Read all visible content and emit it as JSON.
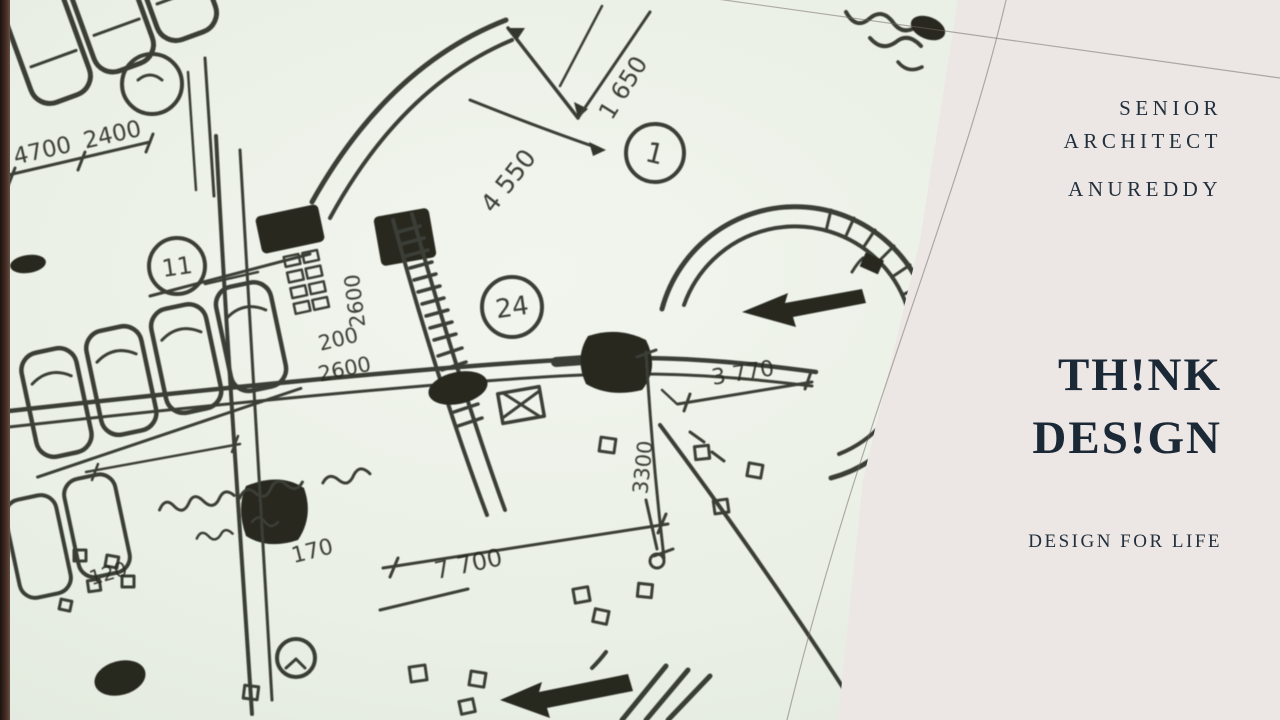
{
  "colors": {
    "panel_bg": "#ece7e5",
    "paper_bg": "#e9efe6",
    "ink": "#2b2e25",
    "accent_navy": "#1b2836",
    "photo_edge_strip": "#3a281f",
    "crease_line": "#70665f"
  },
  "panel": {
    "role_line1": "SENIOR",
    "role_line2": "ARCHITECT",
    "author": "ANUREDDY",
    "title_line1": "TH!NK",
    "title_line2": "DES!GN",
    "tagline": "DESIGN FOR LIFE"
  },
  "sketch": {
    "alt": "hand-drawn architectural floor plan, black ink on white paper",
    "labels": {
      "a4700": "4700",
      "a2400": "2400",
      "a4550": "4 550",
      "a1650": "1 650",
      "m1": "1",
      "m11": "11",
      "m24": "24",
      "v2600": "2600",
      "b200": "200",
      "b2600": "2600",
      "d3770": "3 770",
      "v3300": "3300",
      "d7700": "7 700",
      "c170": "170",
      "c120": "120"
    }
  }
}
